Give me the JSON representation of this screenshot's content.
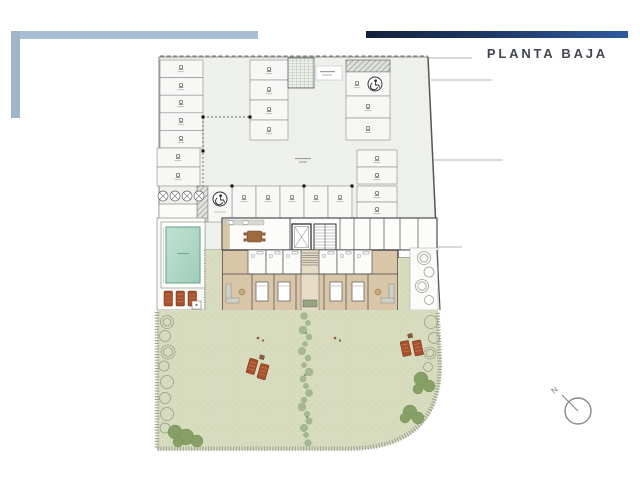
{
  "header": {
    "title": "PLANTA BAJA",
    "title_color": "#43474e",
    "top_bar_gradient_start": "#14213d",
    "top_bar_gradient_end": "#2d5aa0",
    "corner_accent_color": "#a9bed2"
  },
  "compass": {
    "label": "N"
  },
  "plan": {
    "kind": "architectural ground floor plan",
    "colors": {
      "plan_floor": "#eef0ec",
      "lawn": "#d7dcbf",
      "wood_floor": "#d9c5a7",
      "terrace": "#e8dcc2",
      "pool_water": "#a9d3bf",
      "lounger": "#a7502b",
      "gravel_border": "#a3a598"
    },
    "parking": {
      "stall_groups": [
        {
          "id": "left-column",
          "stalls": 7
        },
        {
          "id": "center-column",
          "stalls": 4
        },
        {
          "id": "right-column",
          "stalls": 2
        },
        {
          "id": "mid-pair",
          "stalls": 2
        },
        {
          "id": "bottom-row",
          "stalls": 5
        },
        {
          "id": "bottom-pair",
          "stalls": 2
        },
        {
          "id": "accessible-stalls",
          "stalls": 2
        }
      ],
      "features": [
        "entry-ramp",
        "ventilation-fans",
        "equipment-room",
        "dashed-drive-aisle"
      ]
    },
    "core": {
      "features": [
        "lounge-with-dining-table",
        "elevator",
        "stairs",
        "storerooms"
      ]
    },
    "residences": {
      "units": 2,
      "features": [
        "bathrooms",
        "bedrooms",
        "living-rooms",
        "rear-terraces"
      ]
    },
    "outdoors": {
      "pool_loungers": 3,
      "garden_loungers": 4,
      "features": [
        "pool",
        "pool-terrace",
        "lawn",
        "planted-center-path",
        "perimeter-trees",
        "bushes",
        "side-patio"
      ]
    }
  },
  "icons": {
    "wheelchair": "wheelchair-icon",
    "fan": "fan-icon",
    "north_arrow": "north-arrow-icon"
  }
}
